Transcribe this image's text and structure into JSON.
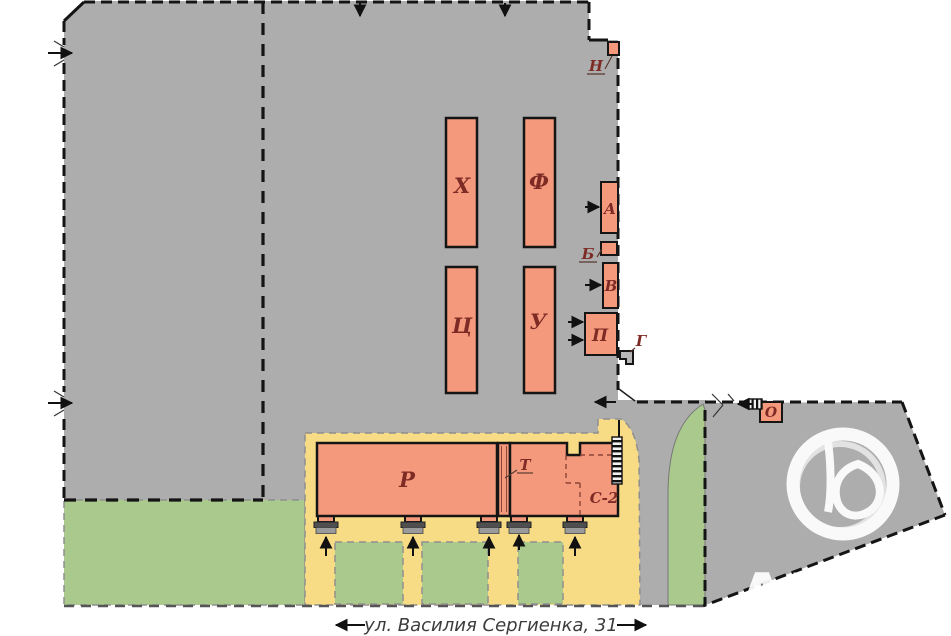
{
  "plan": {
    "street": {
      "label": "ул. Василия Сергиенка, 31"
    },
    "watermark_text": "АН",
    "labels": {
      "kh": "Х",
      "f": "Ф",
      "ts": "Ц",
      "u": "У",
      "a": "А",
      "b": "Б",
      "v": "В",
      "p": "П",
      "g": "Г",
      "n": "Н",
      "r": "Р",
      "t": "Т",
      "s2": "С-2",
      "o": "О"
    },
    "colors": {
      "pavement_gray": "#adadad",
      "building_fill": "#f5997d",
      "yard_yellow": "#f8dc85",
      "lawn_green": "#a9ca8c",
      "structure_gray": "#b8b8b8",
      "boundary_black": "#141414",
      "label_maroon": "#7e2b26",
      "watermark_white": "#ffffff"
    }
  }
}
